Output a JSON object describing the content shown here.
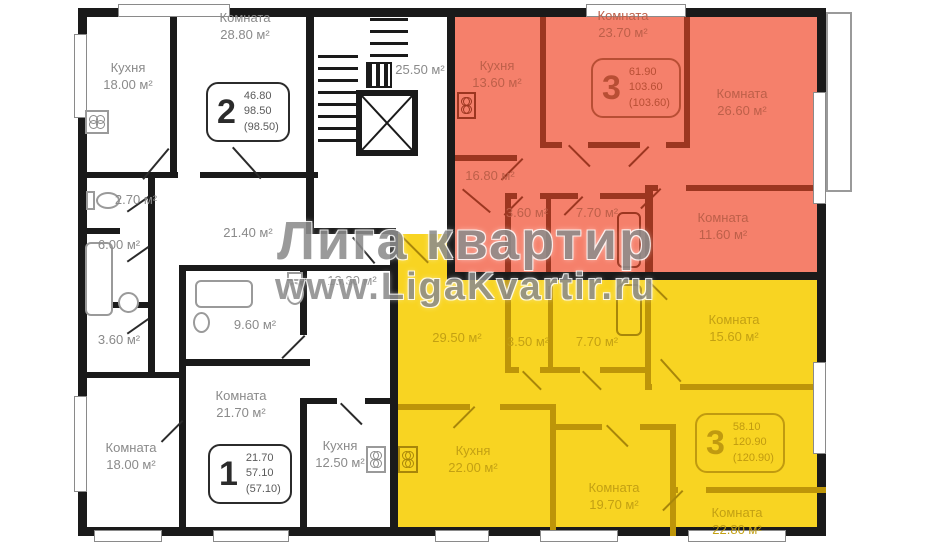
{
  "watermark": {
    "title": "Лига квартир",
    "url": "www.LigaKvartir.ru"
  },
  "common": {
    "stair_area": "25.50 м²"
  },
  "apt2": {
    "badge": {
      "rooms": "2",
      "living": "46.80",
      "total": "98.50",
      "total_note": "(98.50)"
    },
    "kitchen_name": "Кухня",
    "kitchen_area": "18.00 м²",
    "room1_name": "Комната",
    "room1_area": "28.80 м²",
    "room2_name": "Комната",
    "room2_area": "18.00 м²",
    "wc_area": "2.70 м²",
    "bath_area": "6.00 м²",
    "hall_area": "21.40 м²",
    "storage_area": "3.60 м²"
  },
  "apt1": {
    "badge": {
      "rooms": "1",
      "living": "21.70",
      "total": "57.10",
      "total_note": "(57.10)"
    },
    "room_name": "Комната",
    "room_area": "21.70 м²",
    "kitchen_name": "Кухня",
    "kitchen_area": "12.50 м²",
    "bath_area": "9.60 м²",
    "hall_area": "13.30 м²"
  },
  "apt3_red": {
    "badge": {
      "rooms": "3",
      "living": "61.90",
      "total": "103.60",
      "total_note": "(103.60)"
    },
    "kitchen_name": "Кухня",
    "kitchen_area": "13.60 м²",
    "room1_name": "Комната",
    "room1_area": "23.70 м²",
    "room2_name": "Комната",
    "room2_area": "26.60 м²",
    "room3_name": "Комната",
    "room3_area": "11.60 м²",
    "hall_area": "16.80 м²",
    "wc_area": "3.60 м²",
    "bath_area": "7.70 м²"
  },
  "apt3_yellow": {
    "badge": {
      "rooms": "3",
      "living": "58.10",
      "total": "120.90",
      "total_note": "(120.90)"
    },
    "hall_area": "29.50 м²",
    "wc_area": "3.50 м²",
    "bath_area": "7.70 м²",
    "room1_name": "Комната",
    "room1_area": "15.60 м²",
    "kitchen_name": "Кухня",
    "kitchen_area": "22.00 м²",
    "room2_name": "Комната",
    "room2_area": "19.70 м²",
    "room3_name": "Комната",
    "room3_area": "22.80 м²"
  },
  "colors": {
    "salmon_fill": "#f5806b",
    "salmon_text": "#bd5f49",
    "salmon_wall": "#9c3620",
    "yellow_fill": "#f8d422",
    "yellow_text": "#c3a013",
    "yellow_wall": "#bd9509",
    "wall": "#1a1a1a",
    "white_room_text": "#8a8a8a"
  }
}
